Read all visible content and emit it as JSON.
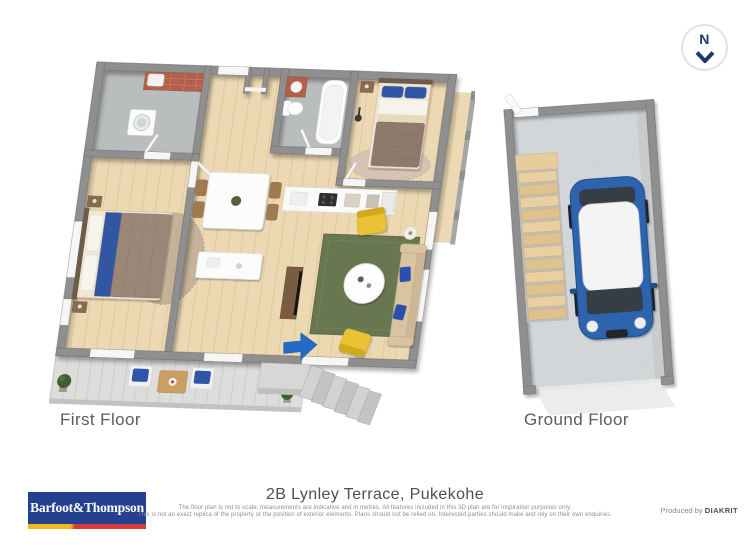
{
  "compass": {
    "label": "N"
  },
  "floors": [
    {
      "label": "First Floor"
    },
    {
      "label": "Ground Floor"
    }
  ],
  "footer": {
    "address": "2B Lynley Terrace, Pukekohe",
    "disclaimer_line1": "The floor plan is not to scale, measurements are indicative and in metres. All features included in this 3D plan are for inspiration purposes only.",
    "disclaimer_line2": "This is not an exact replica of the property or the position of exterior elements. Plans should not be relied on. Interested parties should make and rely on their own enquiries.",
    "produced_by_label": "Produced by",
    "produced_by_brand": "DIAKRIT",
    "logo_text": "Barfoot&Thompson"
  },
  "colors": {
    "brand_blue": "#23418f",
    "logo_yellow": "#f0b91f",
    "logo_red": "#d93a3a",
    "compass_navy": "#1d3a70",
    "entry_arrow_blue": "#2468c8",
    "car_blue": "#2d63ad",
    "rug_green": "#68774f",
    "armchair_yellow": "#e9c335",
    "cushion_blue": "#2f55a8",
    "wall_gray": "#8f8f8f",
    "wood_floor": "#ecd9b4"
  }
}
